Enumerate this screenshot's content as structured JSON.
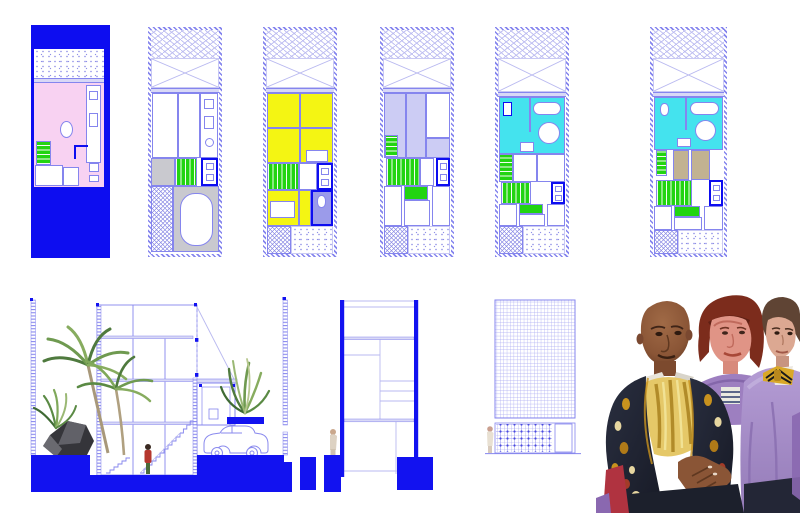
{
  "canvas": {
    "background": "#ffffff",
    "width": 800,
    "height": 513
  },
  "palette": {
    "blue": "#0d0df0",
    "groundBlue": "#1212f0",
    "line": "#8585ee",
    "lineLight": "#c9c9f4",
    "xline": "#b9b9f0",
    "dot": "#8f8fe6",
    "pink": "#f8d2f2",
    "yellow": "#f4f513",
    "green": "#22d411",
    "cyan": "#44e3ee",
    "gray": "#c9c9cf",
    "lavRoom": "#ccccf4",
    "purpleBath": "#9b9bea",
    "tan": "#c2b291"
  },
  "drawings": {
    "plans": [
      {
        "name": "floor-plan-1",
        "highlight": "#f8d2f2"
      },
      {
        "name": "floor-plan-2",
        "highlight": "#c9c9cf"
      },
      {
        "name": "floor-plan-3",
        "highlight": "#f4f513"
      },
      {
        "name": "floor-plan-4",
        "highlight": "#ccccf4"
      },
      {
        "name": "floor-plan-5",
        "highlight": "#44e3ee"
      },
      {
        "name": "floor-plan-6",
        "highlight": "#44e3ee"
      }
    ],
    "sections": [
      {
        "name": "long-section-with-landscape"
      },
      {
        "name": "cross-section-tower"
      },
      {
        "name": "street-elevation-screen"
      }
    ],
    "artwork": {
      "name": "portrait-painting-three-figures"
    }
  }
}
